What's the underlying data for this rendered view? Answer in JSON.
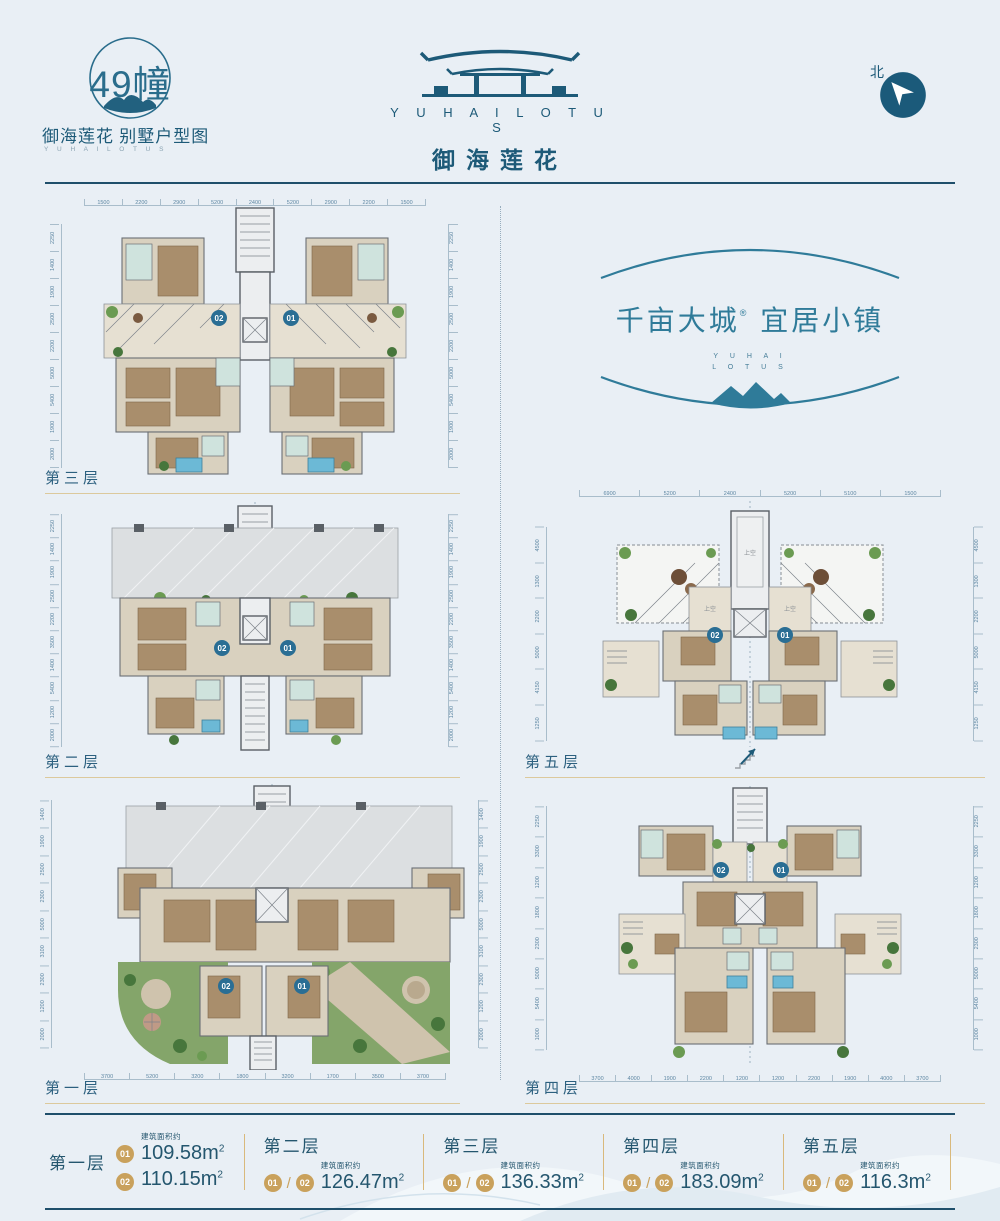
{
  "header": {
    "badge_number_text": "49幢",
    "subtitle": "御海莲花 别墅户型图",
    "subtitle_en": "Y U H A I   L O T U S",
    "logo_en": "Y U H A I   L O T U S",
    "logo_cn": "御海莲花",
    "north_label": "北"
  },
  "slogan": {
    "cn_left": "千亩大城",
    "reg": "®",
    "cn_right": "宜居小镇",
    "en1": "Y U H A I",
    "en2": "L O T U S"
  },
  "plans": {
    "f3": {
      "label": "第三层",
      "unit_left": "02",
      "unit_right": "01",
      "dims_top": [
        "1500",
        "2200",
        "2900",
        "5200",
        "2400",
        "5200",
        "2900",
        "2200",
        "1500"
      ],
      "dims_left": [
        "2250",
        "1400",
        "1900",
        "2500",
        "2200",
        "5000",
        "5400",
        "1900",
        "2000"
      ],
      "dims_right": [
        "2250",
        "1400",
        "1900",
        "2500",
        "2200",
        "5000",
        "5400",
        "1900",
        "2000"
      ]
    },
    "f2": {
      "label": "第二层",
      "unit_left": "02",
      "unit_right": "01",
      "dims_left": [
        "2250",
        "1400",
        "1900",
        "2500",
        "2200",
        "3500",
        "1400",
        "5400",
        "1200",
        "2000"
      ],
      "dims_right": [
        "2250",
        "1400",
        "1900",
        "2500",
        "2200",
        "3500",
        "1400",
        "5400",
        "1200",
        "2000"
      ]
    },
    "f1": {
      "label": "第一层",
      "unit_left": "02",
      "unit_right": "01",
      "dims_bottom": [
        "3700",
        "5200",
        "3200",
        "1800",
        "3200",
        "1700",
        "3500",
        "3700"
      ],
      "dims_left": [
        "1400",
        "1900",
        "2500",
        "2300",
        "5000",
        "3100",
        "2300",
        "1200",
        "2000"
      ],
      "dims_right": [
        "1400",
        "1900",
        "2500",
        "2300",
        "5000",
        "3100",
        "2300",
        "1200",
        "2000"
      ]
    },
    "f5": {
      "label": "第五层",
      "unit_left": "02",
      "unit_right": "01",
      "void_center": "上空",
      "void_side": "上空",
      "dims_top": [
        "6900",
        "5200",
        "2400",
        "5200",
        "5100",
        "1500"
      ],
      "dims_left": [
        "4500",
        "1300",
        "2200",
        "5000",
        "4150",
        "1250"
      ],
      "dims_right": [
        "4500",
        "1300",
        "2200",
        "5000",
        "4150",
        "1250"
      ]
    },
    "f4": {
      "label": "第四层",
      "unit_left": "02",
      "unit_right": "01",
      "dims_bottom": [
        "3700",
        "4000",
        "1900",
        "2200",
        "1200",
        "1200",
        "2200",
        "1900",
        "4000",
        "3700"
      ],
      "dims_left": [
        "2250",
        "3300",
        "1200",
        "1800",
        "2300",
        "5000",
        "5400",
        "1000"
      ],
      "dims_right": [
        "2250",
        "3300",
        "1200",
        "1800",
        "2300",
        "5000",
        "5400",
        "1000"
      ]
    }
  },
  "legend": {
    "area_note": "建筑面积约",
    "unit": "m",
    "sup": "2",
    "slash": "/",
    "groups": [
      {
        "label": "第一层",
        "rows": [
          {
            "badge": "01",
            "value": "109.58"
          },
          {
            "badge": "02",
            "value": "110.15"
          }
        ]
      },
      {
        "label": "第二层",
        "badge1": "01",
        "badge2": "02",
        "value": "126.47"
      },
      {
        "label": "第三层",
        "badge1": "01",
        "badge2": "02",
        "value": "136.33"
      },
      {
        "label": "第四层",
        "badge1": "01",
        "badge2": "02",
        "value": "183.09"
      },
      {
        "label": "第五层",
        "badge1": "01",
        "badge2": "02",
        "value": "116.3"
      }
    ]
  }
}
